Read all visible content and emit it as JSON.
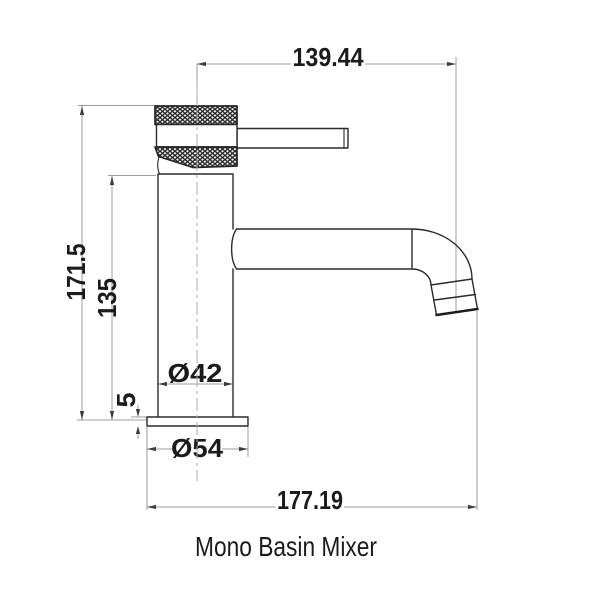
{
  "caption": "Mono Basin Mixer",
  "dimensions": {
    "spout_reach": "139.44",
    "overall_height": "171.5",
    "body_height": "135",
    "body_diameter": "Ø42",
    "base_thickness": "5",
    "base_diameter": "Ø54",
    "overall_projection": "177.19"
  },
  "colors": {
    "outline": "#2a2a2a",
    "dimension_line": "#9c9c9c",
    "text": "#1b1b1b",
    "background": "#ffffff"
  }
}
